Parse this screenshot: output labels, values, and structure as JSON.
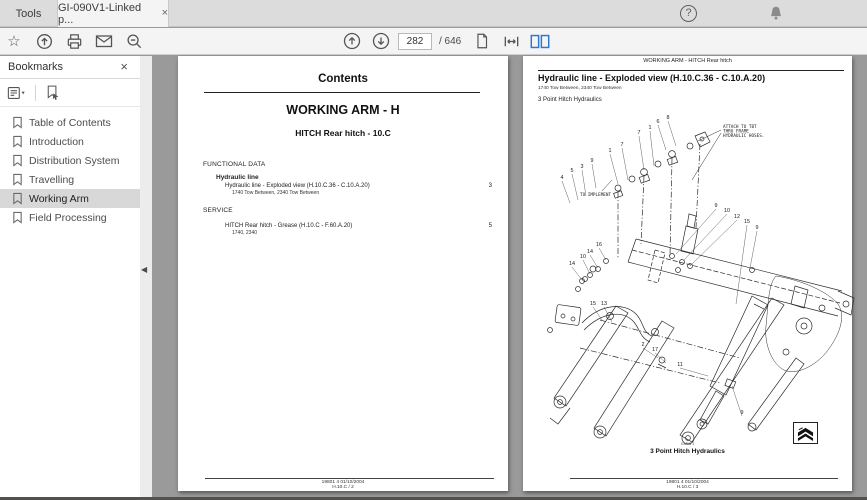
{
  "window": {
    "tab_bar": {
      "tools_tab": "Tools",
      "document_tab": "GI-090V1-Linked p...",
      "close_glyph": "×"
    },
    "toolbar": {
      "page_current": "282",
      "page_total_label": "/ 646"
    }
  },
  "icons": {
    "star_glyph": "☆",
    "help_glyph": "?",
    "collapse_glyph": "◀"
  },
  "sidebar": {
    "title": "Bookmarks",
    "items": [
      "Table of Contents",
      "Introduction",
      "Distribution System",
      "Travelling",
      "Working Arm",
      "Field Processing"
    ],
    "selected_index": 4
  },
  "left_page": {
    "title": "Contents",
    "section_title": "WORKING ARM - H",
    "subsection_title": "HITCH Rear hitch - 10.C",
    "groups": [
      {
        "heading": "FUNCTIONAL DATA",
        "sub": "Hydraulic line",
        "entries": [
          {
            "label": "Hydraulic line - Exploded view (H.10.C.36 - C.10.A.20)",
            "models": "1740 Tow Between, 2340 Tow Between",
            "page": "3"
          }
        ]
      },
      {
        "heading": "SERVICE",
        "sub": "",
        "entries": [
          {
            "label": "HITCH Rear hitch - Grease (H.10.C - F.60.A.20)",
            "models": "1740, 2340",
            "page": "5"
          }
        ]
      }
    ],
    "footer_line1": "19801 4 01/10/2004",
    "footer_line2": "H.10.C / 2"
  },
  "right_page": {
    "header": "WORKING ARM - HITCH Rear hitch",
    "title": "Hydraulic line - Exploded view (H.10.C.36 - C.10.A.20)",
    "models": "1740 Tow Between, 2340 Tow Between",
    "subtitle": "3 Point Hitch Hydraulics",
    "figure_code": "GM06  1",
    "caption": "3 Point Hitch Hydraulics",
    "footer_line1": "19801 4 01/10/2004",
    "footer_line2": "H.10.C / 3",
    "diagram": {
      "annotations": [
        {
          "lines": [
            "ATTACH TO TBT",
            "THRU FRAME",
            "HYDRAULIC HOSES."
          ],
          "x": 183,
          "y": 20
        },
        {
          "lines": [
            "TO IMPLEMENT"
          ],
          "x": 40,
          "y": 88
        }
      ],
      "callouts": [
        {
          "label": "4",
          "x": 22,
          "y": 71,
          "lx": 30,
          "ly": 95
        },
        {
          "label": "5",
          "x": 32,
          "y": 64,
          "lx": 38,
          "ly": 92
        },
        {
          "label": "3",
          "x": 42,
          "y": 60,
          "lx": 46,
          "ly": 88
        },
        {
          "label": "9",
          "x": 52,
          "y": 54,
          "lx": 56,
          "ly": 80
        },
        {
          "label": "1",
          "x": 70,
          "y": 44,
          "lx": 78,
          "ly": 76
        },
        {
          "label": "7",
          "x": 82,
          "y": 38,
          "lx": 88,
          "ly": 72
        },
        {
          "label": "7",
          "x": 99,
          "y": 26,
          "lx": 104,
          "ly": 62
        },
        {
          "label": "1",
          "x": 110,
          "y": 21,
          "lx": 114,
          "ly": 58
        },
        {
          "label": "6",
          "x": 118,
          "y": 15,
          "lx": 126,
          "ly": 42
        },
        {
          "label": "8",
          "x": 128,
          "y": 11,
          "lx": 136,
          "ly": 38
        },
        {
          "label": "9",
          "x": 176,
          "y": 99,
          "lx": 136,
          "ly": 146
        },
        {
          "label": "10",
          "x": 187,
          "y": 104,
          "lx": 144,
          "ly": 152
        },
        {
          "label": "12",
          "x": 197,
          "y": 110,
          "lx": 150,
          "ly": 158
        },
        {
          "label": "15",
          "x": 207,
          "y": 115,
          "lx": 196,
          "ly": 196
        },
        {
          "label": "9",
          "x": 217,
          "y": 121,
          "lx": 210,
          "ly": 160
        },
        {
          "label": "16",
          "x": 59,
          "y": 138,
          "lx": 66,
          "ly": 152
        },
        {
          "label": "14",
          "x": 50,
          "y": 145,
          "lx": 58,
          "ly": 160
        },
        {
          "label": "10",
          "x": 43,
          "y": 150,
          "lx": 50,
          "ly": 166
        },
        {
          "label": "14",
          "x": 32,
          "y": 157,
          "lx": 42,
          "ly": 172
        },
        {
          "label": "15",
          "x": 53,
          "y": 197,
          "lx": 62,
          "ly": 212
        },
        {
          "label": "13",
          "x": 64,
          "y": 197,
          "lx": 72,
          "ly": 214
        },
        {
          "label": "2",
          "x": 103,
          "y": 238,
          "lx": 118,
          "ly": 250
        },
        {
          "label": "17",
          "x": 115,
          "y": 243,
          "lx": 126,
          "ly": 255
        },
        {
          "label": "11",
          "x": 140,
          "y": 258,
          "lx": 168,
          "ly": 268
        },
        {
          "label": "9",
          "x": 202,
          "y": 306,
          "lx": 192,
          "ly": 278
        }
      ]
    }
  },
  "colors": {
    "accent_blue": "#2a78d6",
    "avatar_blue": "#1a73e8",
    "doc_background": "#9a9a9a",
    "selection_gray": "#d8d8d8"
  }
}
